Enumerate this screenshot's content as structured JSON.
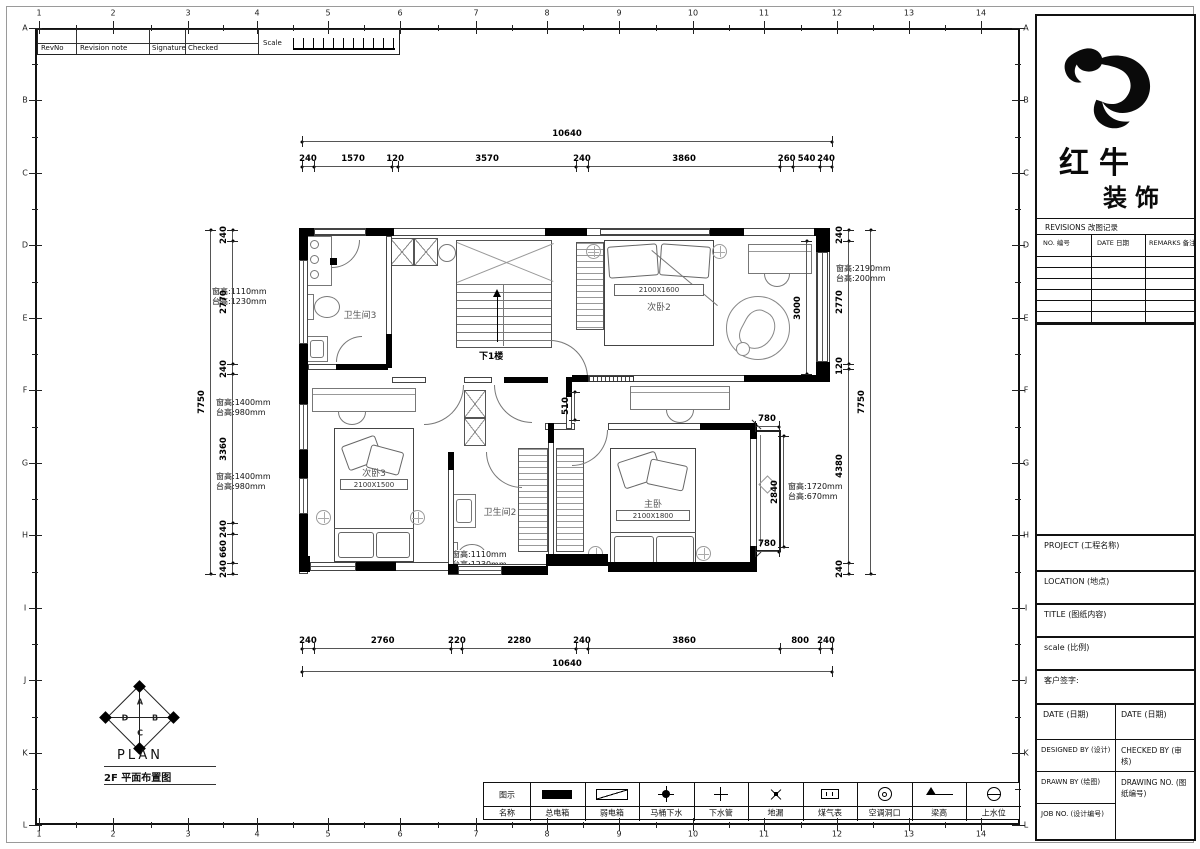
{
  "sheet": {
    "grid_columns": [
      "1",
      "2",
      "3",
      "4",
      "5",
      "6",
      "7",
      "8",
      "9",
      "10",
      "11",
      "12",
      "13",
      "14"
    ],
    "grid_rows": [
      "A",
      "B",
      "C",
      "D",
      "E",
      "F",
      "G",
      "H",
      "I",
      "J",
      "K",
      "L"
    ],
    "revision_strip": {
      "rev_no": "RevNo",
      "revision_note": "Revision note",
      "signature": "Signature",
      "checked": "Checked",
      "scale_label": "Scale"
    }
  },
  "plan": {
    "rooms": {
      "bath3": {
        "label": "卫生间3"
      },
      "bed2": {
        "label": "次卧2",
        "size": "2100X1600"
      },
      "bed3": {
        "label": "次卧3",
        "size": "2100X1500"
      },
      "master": {
        "label": "主卧",
        "size": "2100X1800"
      },
      "bath2": {
        "label": "卫生间2"
      },
      "stairs": {
        "label": "下1楼"
      }
    },
    "window_notes": [
      {
        "win": "窗高:1110mm",
        "sill": "台高:1230mm"
      },
      {
        "win": "窗高:1400mm",
        "sill": "台高:980mm"
      },
      {
        "win": "窗高:1400mm",
        "sill": "台高:980mm"
      },
      {
        "win": "窗高:2190mm",
        "sill": "台高:200mm"
      },
      {
        "win": "窗高:1720mm",
        "sill": "台高:670mm"
      },
      {
        "win": "窗高:1110mm",
        "sill": "台高:1230mm"
      }
    ],
    "dimensions": {
      "top_overall": "10640",
      "top_segments": [
        "240",
        "1570",
        "120",
        "3570",
        "240",
        "3860",
        "260",
        "540",
        "240"
      ],
      "bottom_segments": [
        "240",
        "2760",
        "220",
        "2280",
        "240",
        "3860",
        "800",
        "240"
      ],
      "bottom_overall": "10640",
      "left_segments": [
        "240",
        "2770",
        "240",
        "3360",
        "240",
        "660",
        "240"
      ],
      "left_overall": "7750",
      "right_segments": [
        "240",
        "2770",
        "120",
        "4380",
        "240"
      ],
      "right_overall": "7750",
      "bed2_inner_depth": "3000",
      "bay_top": "780",
      "bay_bottom": "780",
      "bay_height": "2840",
      "nook": "510"
    }
  },
  "plan_label": {
    "compass": [
      "A",
      "B",
      "C",
      "D"
    ],
    "title": "PLAN",
    "subtitle": "2F 平面布置图"
  },
  "legend": {
    "symbol_header": "图示",
    "name_header": "名称",
    "items": [
      "总电箱",
      "弱电箱",
      "马桶下水",
      "下水管",
      "地漏",
      "煤气表",
      "空调洞口",
      "梁高",
      "上水位"
    ]
  },
  "title_block": {
    "brand_line1": "红牛",
    "brand_line2": "装饰",
    "revisions_title": "REVISIONS 改图记录",
    "revision_columns": [
      "NO. 编号",
      "DATE 日期",
      "REMARKS 备注"
    ],
    "project": "PROJECT (工程名称)",
    "location": "LOCATION (地点)",
    "title": "TITLE (图纸内容)",
    "scale": "scale (比例)",
    "customer_signature": "客户签字:",
    "date_left": "DATE (日期)",
    "date_right": "DATE (日期)",
    "designed_by": "DESIGNED BY (设计)",
    "checked_by": "CHECKED BY (审核)",
    "drawn_by": "DRAWN BY (绘图)",
    "drawing_no": "DRAWING NO. (图纸编号)",
    "job_no": "JOB NO. (设计编号)"
  }
}
